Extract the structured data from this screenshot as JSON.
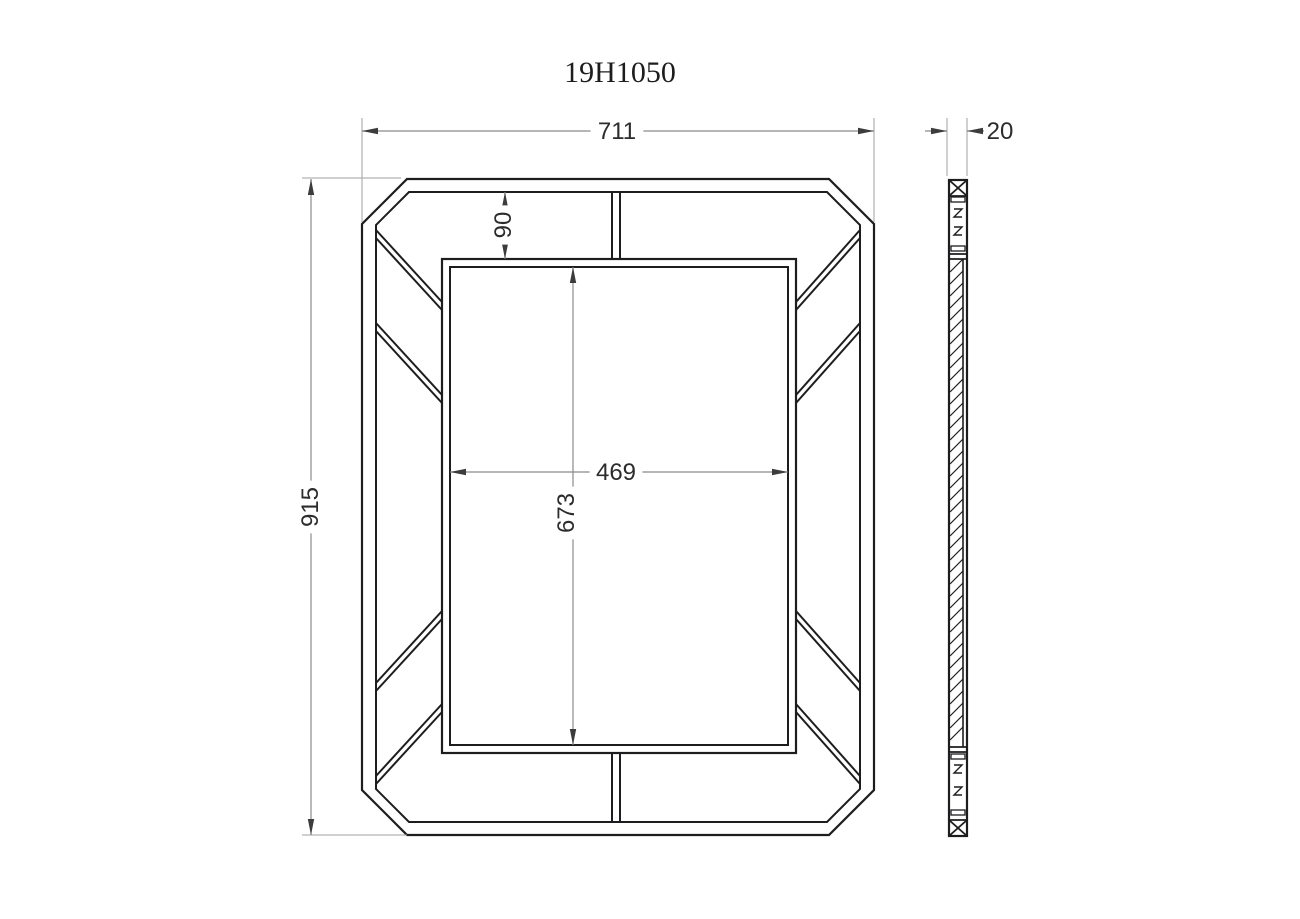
{
  "title": "19H1050",
  "front_view": {
    "name": "mirror front elevation",
    "dimensions": {
      "width": "711",
      "height": "915",
      "top_inset": "90",
      "mirror_width": "469",
      "mirror_height": "673"
    }
  },
  "side_view": {
    "name": "mirror side section",
    "dimensions": {
      "thickness": "20"
    }
  },
  "colors": {
    "background": "#ffffff",
    "main_line": "#1d1d1f",
    "dim_line": "#8b8b8b",
    "ext_line": "#a0a0a0",
    "arrow": "#3c3c3c",
    "text": "#2c2c2c"
  },
  "geometry": {
    "front": {
      "outer_octagon": [
        [
          407,
          179
        ],
        [
          829,
          179
        ],
        [
          874,
          224
        ],
        [
          874,
          790
        ],
        [
          829,
          835
        ],
        [
          407,
          835
        ],
        [
          362,
          790
        ],
        [
          362,
          224
        ]
      ],
      "inner_octagon": [
        [
          409,
          192
        ],
        [
          827,
          192
        ],
        [
          860,
          225
        ],
        [
          860,
          789
        ],
        [
          827,
          822
        ],
        [
          409,
          822
        ],
        [
          376,
          789
        ],
        [
          376,
          225
        ]
      ],
      "mirror_outer": [
        442,
        259,
        354,
        494
      ],
      "mirror_inner": [
        450,
        267,
        338,
        478
      ],
      "struts": [
        [
          376,
          230,
          442,
          302
        ],
        [
          376,
          238,
          442,
          310
        ],
        [
          376,
          323,
          442,
          395
        ],
        [
          376,
          331,
          442,
          403
        ],
        [
          860,
          230,
          796,
          302
        ],
        [
          860,
          238,
          796,
          310
        ],
        [
          860,
          323,
          796,
          395
        ],
        [
          860,
          331,
          796,
          403
        ],
        [
          376,
          784,
          442,
          712
        ],
        [
          376,
          776,
          442,
          704
        ],
        [
          376,
          691,
          442,
          619
        ],
        [
          376,
          683,
          442,
          611
        ],
        [
          860,
          784,
          796,
          712
        ],
        [
          860,
          776,
          796,
          704
        ],
        [
          860,
          691,
          796,
          619
        ],
        [
          860,
          683,
          796,
          611
        ],
        [
          612,
          192,
          612,
          259
        ],
        [
          620,
          192,
          620,
          259
        ],
        [
          612,
          753,
          612,
          822
        ],
        [
          620,
          753,
          620,
          822
        ]
      ]
    },
    "side": {
      "outline": [
        949,
        180,
        18,
        656
      ],
      "xbox_lines": [
        [
          949,
          196,
          967,
          196
        ],
        [
          949,
          820,
          967,
          820
        ],
        [
          949,
          180,
          967,
          196
        ],
        [
          967,
          180,
          949,
          196
        ],
        [
          949,
          820,
          967,
          836
        ],
        [
          967,
          820,
          949,
          836
        ]
      ],
      "caps": [
        [
          949,
          254,
          967,
          254
        ],
        [
          949,
          259,
          967,
          259
        ],
        [
          949,
          747,
          967,
          747
        ],
        [
          949,
          752,
          967,
          752
        ]
      ],
      "tenons": [
        [
          951,
          197,
          14,
          5
        ],
        [
          951,
          246,
          14,
          5
        ],
        [
          951,
          754,
          14,
          5
        ],
        [
          951,
          810,
          14,
          5
        ]
      ],
      "zigzags": [
        [
          958,
          213
        ],
        [
          958,
          231
        ],
        [
          958,
          769
        ],
        [
          958,
          791
        ]
      ],
      "glass": {
        "x1": 950,
        "x2": 963,
        "y1": 259,
        "y2": 747,
        "face_x": 963,
        "hatch_step": 12
      }
    },
    "ext_lines": [
      [
        362,
        118,
        362,
        222
      ],
      [
        874,
        118,
        874,
        222
      ],
      [
        302,
        178,
        401,
        178
      ],
      [
        302,
        835,
        407,
        835
      ],
      [
        947,
        118,
        947,
        176
      ],
      [
        967,
        118,
        967,
        176
      ]
    ],
    "dims": [
      {
        "name": "frame-width",
        "orient": "h",
        "line": [
          362,
          131,
          874,
          131
        ],
        "text_at": [
          617,
          131
        ],
        "bind": "front_view.dimensions.width"
      },
      {
        "name": "frame-height",
        "orient": "v",
        "line": [
          311,
          179,
          311,
          835
        ],
        "text_at": [
          310,
          507
        ],
        "bind": "front_view.dimensions.height"
      },
      {
        "name": "top-inset",
        "orient": "v",
        "line": [
          505,
          192,
          505,
          259
        ],
        "text_at": [
          503,
          225
        ],
        "bind": "front_view.dimensions.top_inset"
      },
      {
        "name": "mirror-width",
        "orient": "h",
        "line": [
          450,
          472,
          788,
          472
        ],
        "text_at": [
          616,
          472
        ],
        "bind": "front_view.dimensions.mirror_width"
      },
      {
        "name": "mirror-height",
        "orient": "v",
        "line": [
          573,
          267,
          573,
          745
        ],
        "text_at": [
          566,
          513
        ],
        "bind": "front_view.dimensions.mirror_height"
      },
      {
        "name": "thickness",
        "orient": "h-out",
        "line": [
          947,
          131,
          967,
          131
        ],
        "tails": [
          925,
          984
        ],
        "text_at": [
          1000,
          131
        ],
        "bind": "side_view.dimensions.thickness"
      }
    ],
    "title_at": [
      620,
      82
    ]
  }
}
